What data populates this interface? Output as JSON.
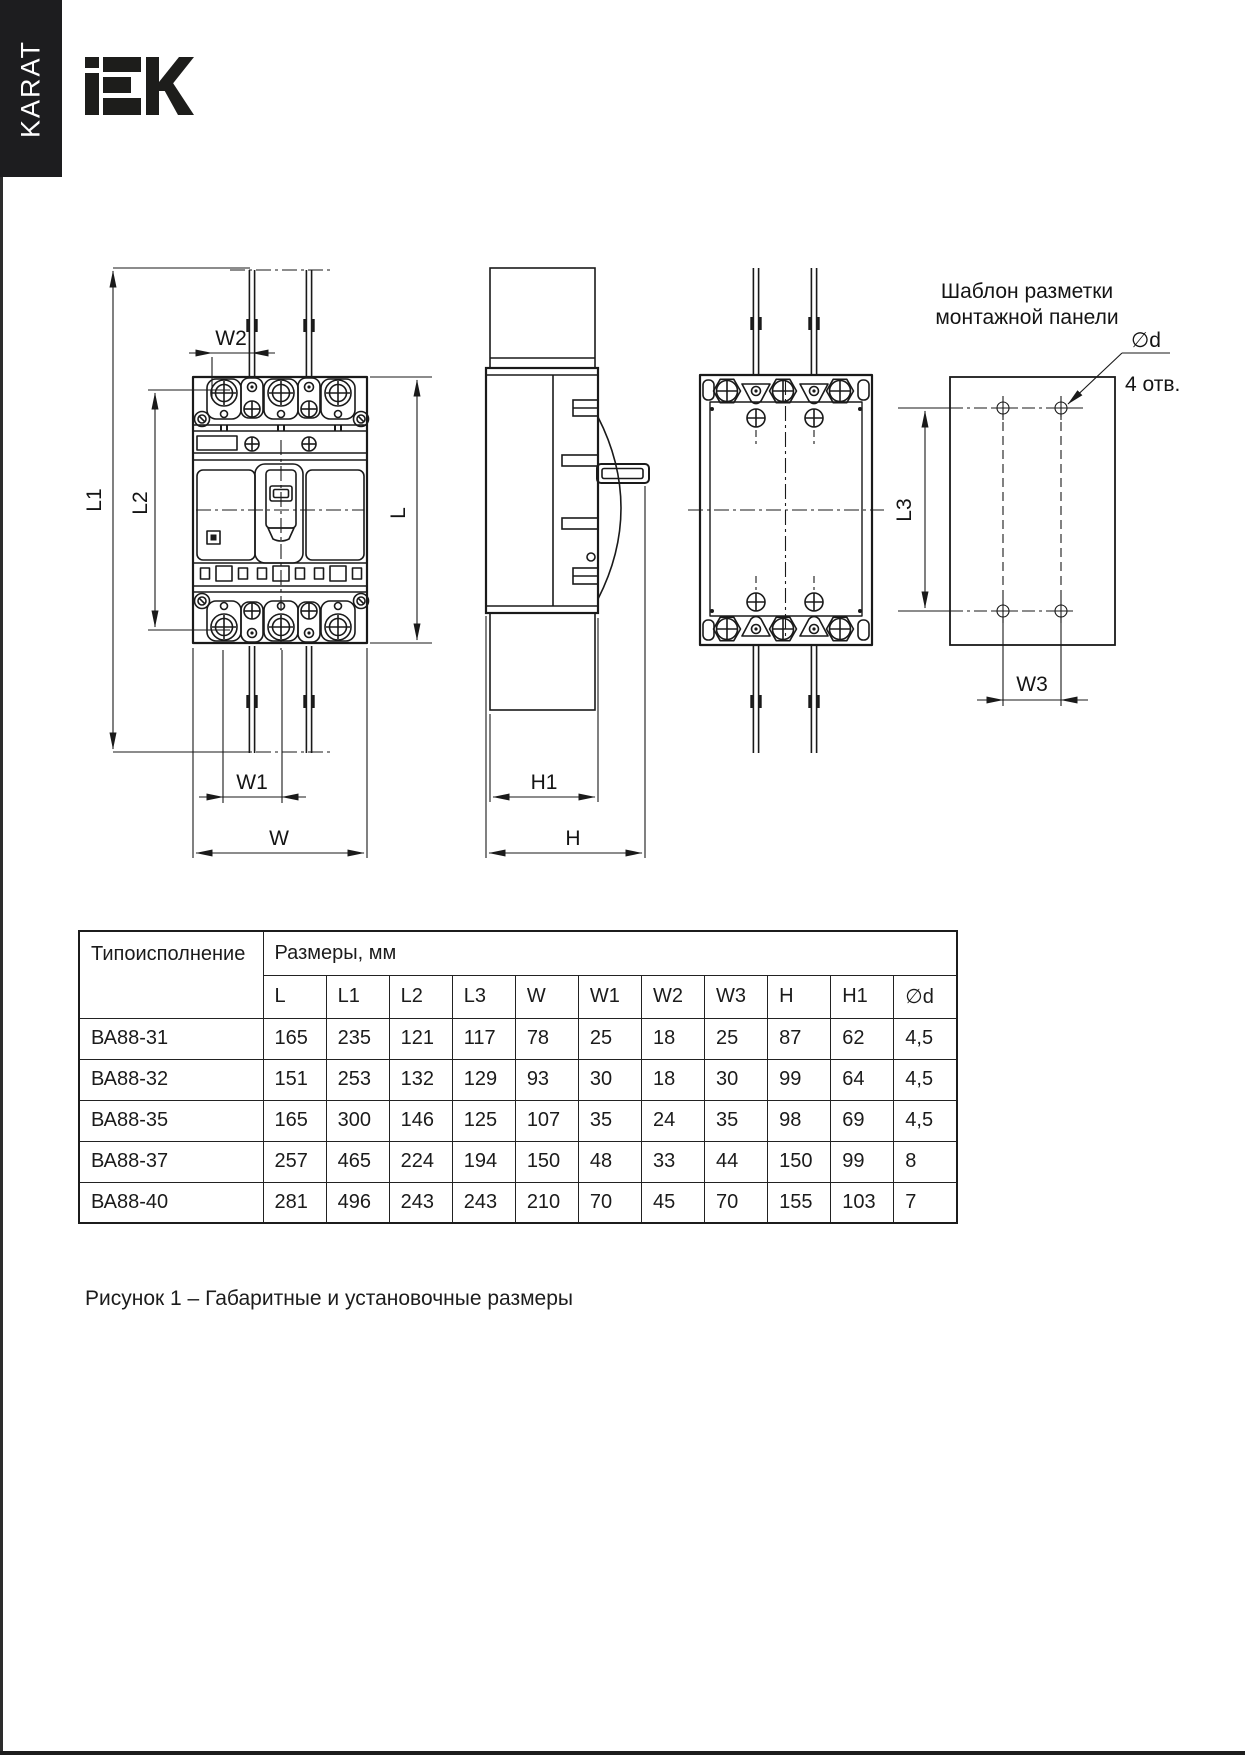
{
  "page": {
    "brand_tab": "KARAT",
    "logo_text": "IEK",
    "caption": "Рисунок 1 – Габаритные и установочные размеры"
  },
  "drawing": {
    "labels": {
      "l": "L",
      "l1": "L1",
      "l2": "L2",
      "l3": "L3",
      "w": "W",
      "w1": "W1",
      "w2": "W2",
      "w3": "W3",
      "h": "H",
      "h1": "H1",
      "d": "∅d",
      "holes": "4 отв.",
      "template_title_1": "Шаблон разметки",
      "template_title_2": "монтажной панели"
    }
  },
  "table": {
    "col1_header": "Типоисполнение",
    "group_header": "Размеры, мм",
    "columns": [
      "L",
      "L1",
      "L2",
      "L3",
      "W",
      "W1",
      "W2",
      "W3",
      "H",
      "H1",
      "∅d"
    ],
    "rows": [
      {
        "name": "ВА88-31",
        "values": [
          "165",
          "235",
          "121",
          "117",
          "78",
          "25",
          "18",
          "25",
          "87",
          "62",
          "4,5"
        ]
      },
      {
        "name": "ВА88-32",
        "values": [
          "151",
          "253",
          "132",
          "129",
          "93",
          "30",
          "18",
          "30",
          "99",
          "64",
          "4,5"
        ]
      },
      {
        "name": "ВА88-35",
        "values": [
          "165",
          "300",
          "146",
          "125",
          "107",
          "35",
          "24",
          "35",
          "98",
          "69",
          "4,5"
        ]
      },
      {
        "name": "ВА88-37",
        "values": [
          "257",
          "465",
          "224",
          "194",
          "150",
          "48",
          "33",
          "44",
          "150",
          "99",
          "8"
        ]
      },
      {
        "name": "ВА88-40",
        "values": [
          "281",
          "496",
          "243",
          "243",
          "210",
          "70",
          "45",
          "70",
          "155",
          "103",
          "7"
        ]
      }
    ]
  }
}
